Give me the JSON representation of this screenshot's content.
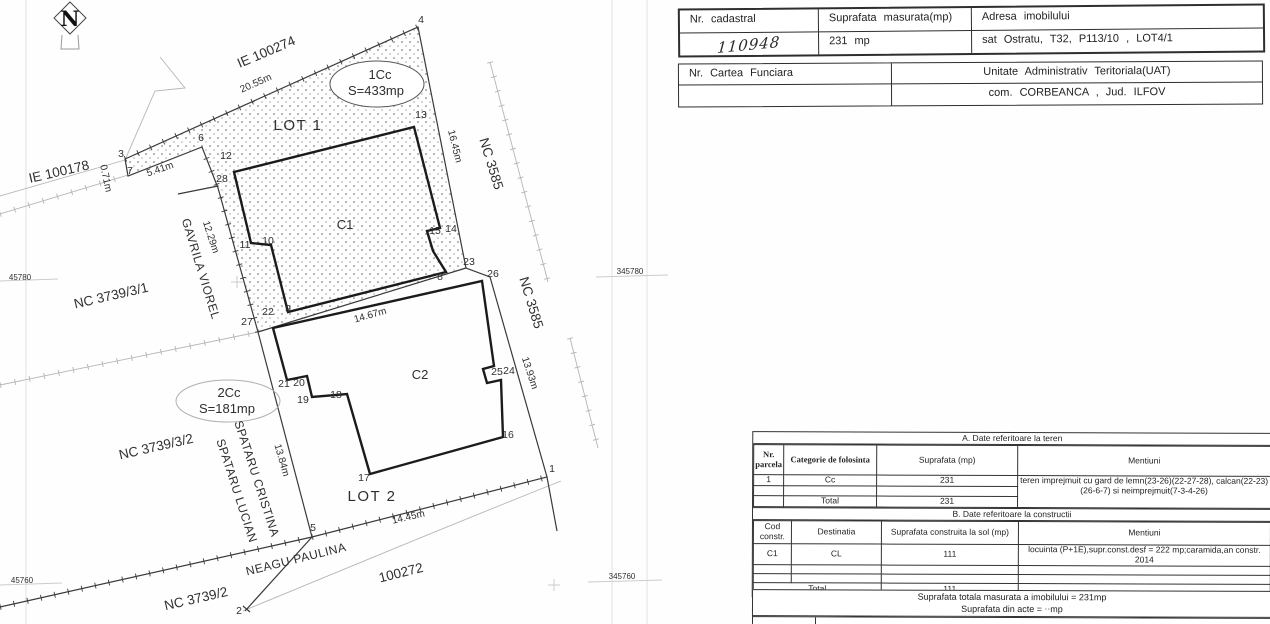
{
  "map": {
    "north": "N",
    "grid_labels": {
      "left_top": "45780",
      "left_bottom": "45760",
      "right_top": "345780",
      "right_bottom": "345760"
    },
    "parcels": {
      "ie100274": "IE 100274",
      "ie100178": "IE 100178",
      "nc3585a": "NC 3585",
      "nc3585b": "NC 3585",
      "nc3739_3_1": "NC 3739/3/1",
      "nc3739_3_2": "NC 3739/3/2",
      "nc3739_2": "NC 3739/2",
      "p100272": "100272"
    },
    "owners": {
      "gavrila": "GAVRILA VIOREL",
      "spataru_c": "SPATARU CRISTINA",
      "spataru_l": "SPATARU LUCIAN",
      "neagu": "NEAGU PAULINA"
    },
    "lot1": {
      "name": "LOT 1",
      "code": "1Cc",
      "area": "S=433mp"
    },
    "lot2": {
      "name": "LOT 2",
      "code": "2Cc",
      "area": "S=181mp"
    },
    "c1": "C1",
    "c2": "C2",
    "dims": {
      "top": "20.55m",
      "step": "5.41m",
      "corner": "0.71m",
      "left": "12.29m",
      "right_up": "16.45m",
      "mid": "14.67m",
      "right_low": "13.93m",
      "left_low": "13.84m",
      "bottom": "14.45m"
    },
    "pts": {
      "p1": "1",
      "p2": "2",
      "p3": "3",
      "p4": "4",
      "p5": "5",
      "p6": "6",
      "p7": "7",
      "p8": "8",
      "p9": "9",
      "p10": "10",
      "p11": "11",
      "p12": "12",
      "p13": "13",
      "p14": "14",
      "p15": "15",
      "p16": "16",
      "p17": "17",
      "p18": "18",
      "p19": "19",
      "p20": "20",
      "p21": "21",
      "p22": "22",
      "p23": "23",
      "p24": "24",
      "p25": "25",
      "p26": "26",
      "p27": "27",
      "p28": "28"
    }
  },
  "top_tables": {
    "cadastral": {
      "h_nr": "Nr. cadastral",
      "h_sup": "Suprafata masurata(mp)",
      "h_adr": "Adresa imobilului",
      "nr": "110948",
      "sup": "231 mp",
      "adr": "sat Ostratu, T32, P113/10 , LOT4/1"
    },
    "cf": {
      "h_cf": "Nr. Cartea Funciara",
      "h_uat": "Unitate Administrativ Teritoriala(UAT)",
      "cf": "",
      "uat": "com. CORBEANCA , Jud. ILFOV"
    }
  },
  "teren": {
    "title": "A.  Date referitoare la teren",
    "h_nr": "Nr. parcela",
    "h_cat": "Categorie de folosinta",
    "h_sup": "Suprafata (mp)",
    "h_men": "Mentiuni",
    "r1": {
      "nr": "1",
      "cat": "Cc",
      "sup": "231"
    },
    "mentiuni": "teren imprejmuit cu gard de lemn(23-26)(22-27-28), calcan(22-23)(26-6-7) si neimprejmuit(7-3-4-26)",
    "total_label": "Total",
    "total": "231"
  },
  "constructii": {
    "title": "B.  Date referitoare la constructii",
    "h_cod": "Cod constr.",
    "h_dest": "Destinatia",
    "h_sup": "Suprafata construita la sol (mp)",
    "h_men": "Mentiuni",
    "r1": {
      "cod": "C1",
      "dest": "CL",
      "sup": "111",
      "men": "locuinta (P+1E),supr.const.desf = 222 mp;caramida,an constr. 2014"
    },
    "total_label": "Total",
    "total": "111"
  },
  "footer": {
    "line1": "Suprafata  totala  masurata  a imobilului =  231mp",
    "line2_prefix": "Suprafata  din  acte =",
    "line2_value": "··",
    "line2_suffix": "mp"
  }
}
